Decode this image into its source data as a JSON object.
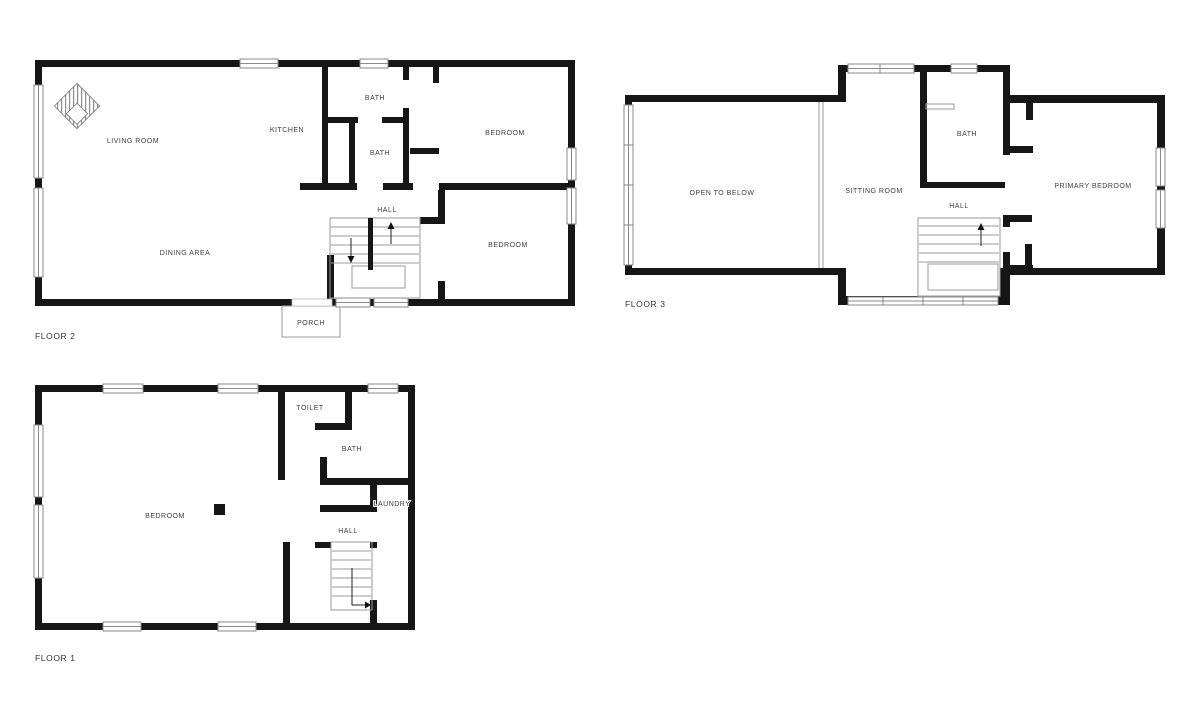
{
  "figure": {
    "type": "floor-plan",
    "background": "#ffffff"
  },
  "colors": {
    "wall": "#161616",
    "label_text": "#3d3d3d",
    "thin_line": "#9a9a9a",
    "window_frame": "#8a8a8a"
  },
  "floors": {
    "floor2": {
      "label": "FLOOR 2",
      "rooms": {
        "living_room": "LIVING ROOM",
        "kitchen": "KITCHEN",
        "bath_upper": "BATH",
        "bath_lower": "BATH",
        "bedroom_upper": "BEDROOM",
        "hall": "HALL",
        "dining_area": "DINING AREA",
        "bedroom_lower": "BEDROOM",
        "porch": "PORCH"
      }
    },
    "floor3": {
      "label": "FLOOR 3",
      "rooms": {
        "open_to_below": "OPEN TO BELOW",
        "sitting_room": "SITTING ROOM",
        "bath": "BATH",
        "hall": "HALL",
        "primary_bedroom": "PRIMARY BEDROOM"
      }
    },
    "floor1": {
      "label": "FLOOR 1",
      "rooms": {
        "bedroom": "BEDROOM",
        "toilet": "TOILET",
        "bath": "BATH",
        "laundry": "LAUNDRY",
        "hall": "HALL"
      }
    }
  },
  "icons": {
    "fireplace": "hatched-diamond-fireplace",
    "stairs_up_arrow": "up",
    "stairs_down_arrow": "down",
    "stairs_exit_arrow": "right"
  }
}
